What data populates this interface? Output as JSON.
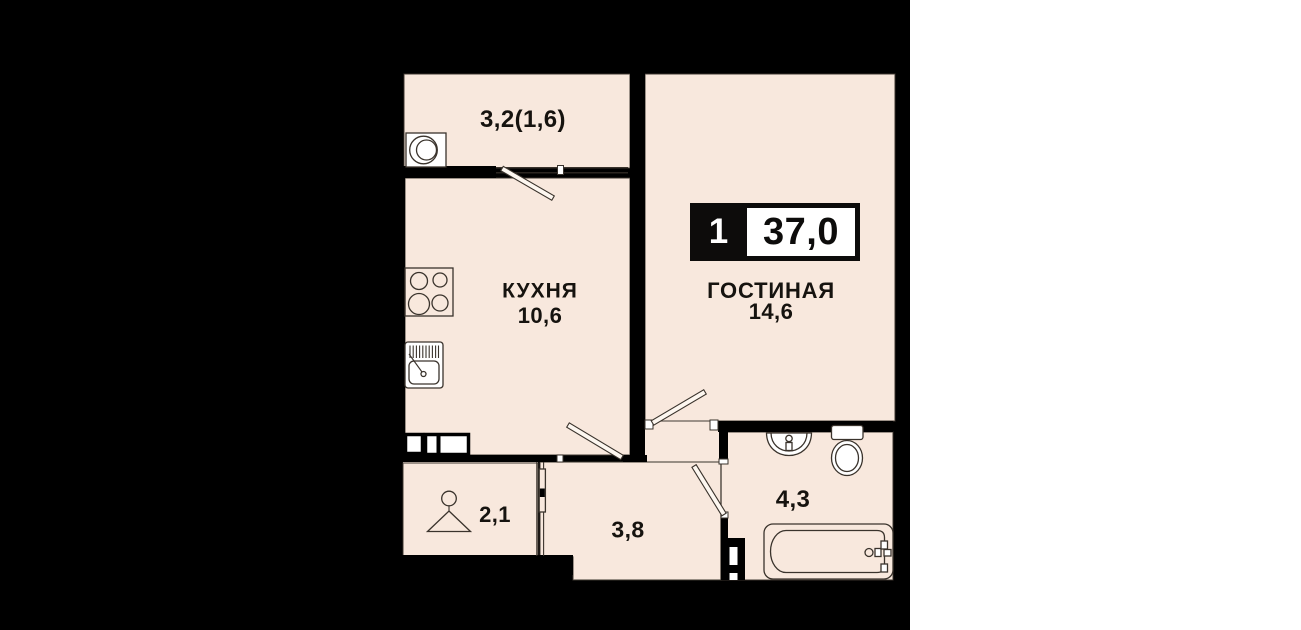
{
  "plan": {
    "badge": {
      "rooms_count": "1",
      "total_area": "37,0"
    },
    "rooms": {
      "balcony": {
        "area_label": "3,2(1,6)"
      },
      "kitchen": {
        "name": "КУХНЯ",
        "area": "10,6"
      },
      "living": {
        "name": "ГОСТИНАЯ",
        "area": "14,6"
      },
      "hall": {
        "area": "2,1"
      },
      "corridor": {
        "area": "3,8"
      },
      "bathroom": {
        "area": "4,3"
      }
    },
    "colors": {
      "page": "#ffffff",
      "panel": "#000000",
      "floor": "#f8e8dd",
      "line": "#3a332c",
      "ink": "#16130f",
      "badge_bg": "#0d0c0b",
      "badge_box": "#ffffff"
    }
  }
}
